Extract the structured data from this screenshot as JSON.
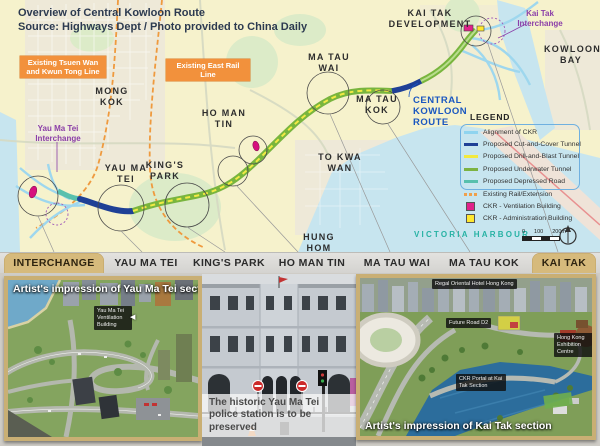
{
  "header": {
    "title": "Overview of Central Kowloon Route",
    "source": "Source: Highways Dept / Photo provided to China Daily"
  },
  "map": {
    "labels": {
      "tsuen_wan_line": "Existing Tsuen Wan and Kwun Tong Line",
      "east_rail_line": "Existing East Rail Line",
      "mong_kok": "MONG KOK",
      "ho_man_tin": "HO MAN TIN",
      "yau_ma_tei": "YAU MA TEI",
      "kings_park": "KING'S PARK",
      "to_kwa_wan": "TO KWA WAN",
      "hung_hom": "HUNG HOM",
      "ma_tau_wai": "MA TAU WAI",
      "ma_tau_kok": "MA TAU KOK",
      "kai_tak_development": "KAI TAK DEVELOPMENT",
      "kowloon_bay": "KOWLOON BAY",
      "yau_ma_tei_interchange": "Yau Ma Tei Interchange",
      "kai_tak_interchange": "Kai Tak Interchange",
      "central_kowloon_route": "CENTRAL KOWLOON ROUTE",
      "victoria_harbour": "VICTORIA HARBOUR"
    },
    "legend": {
      "title": "LEGEND",
      "items": [
        {
          "label": "Alignment of CKR",
          "color": "#8fd4ef",
          "style": "line"
        },
        {
          "label": "Proposed Cut-and-Cover Tunnel",
          "color": "#1f4096",
          "style": "line"
        },
        {
          "label": "Proposed Drill-and-Blast Tunnel",
          "color": "#f2e93f",
          "style": "line"
        },
        {
          "label": "Proposed Underwater Tunnel",
          "color": "#7cb342",
          "style": "line"
        },
        {
          "label": "Proposed Depressed Road",
          "color": "#58c0ad",
          "style": "line"
        },
        {
          "label": "Existing Rail/Extension",
          "color": "#f0a04b",
          "style": "dashed"
        },
        {
          "label": "CKR - Ventilation Building",
          "color": "#e0218a",
          "style": "square"
        },
        {
          "label": "CKR - Administration Building",
          "color": "#ffe72e",
          "style": "square"
        }
      ]
    },
    "scale": {
      "t0": "0",
      "t1": "100",
      "t2": "200m"
    }
  },
  "tabs": [
    {
      "label": "INTERCHANGE",
      "active": true
    },
    {
      "label": "YAU MA TEI",
      "active": false
    },
    {
      "label": "KING'S PARK",
      "active": false
    },
    {
      "label": "HO MAN TIN",
      "active": false
    },
    {
      "label": "MA TAU WAI",
      "active": false
    },
    {
      "label": "MA TAU KOK",
      "active": false
    },
    {
      "label": "KAI TAK",
      "active": true
    }
  ],
  "photos": {
    "left": {
      "caption": "Artist's impression of Yau Ma Tei section",
      "building_label": "Yau Ma Tei Ventilation Building"
    },
    "middle": {
      "caption_line1": "The historic Yau Ma Tei",
      "caption_line2": "police station is to be preserved"
    },
    "right": {
      "caption": "Artist's impression of Kai Tak section",
      "label_hotel": "Regal Oriental Hotel Hong Kong",
      "label_road": "Future Road D2",
      "label_exhibition": "Hong Kong Exhibition Centre",
      "label_portal": "CKR Portal at Kai Tak Section"
    }
  }
}
